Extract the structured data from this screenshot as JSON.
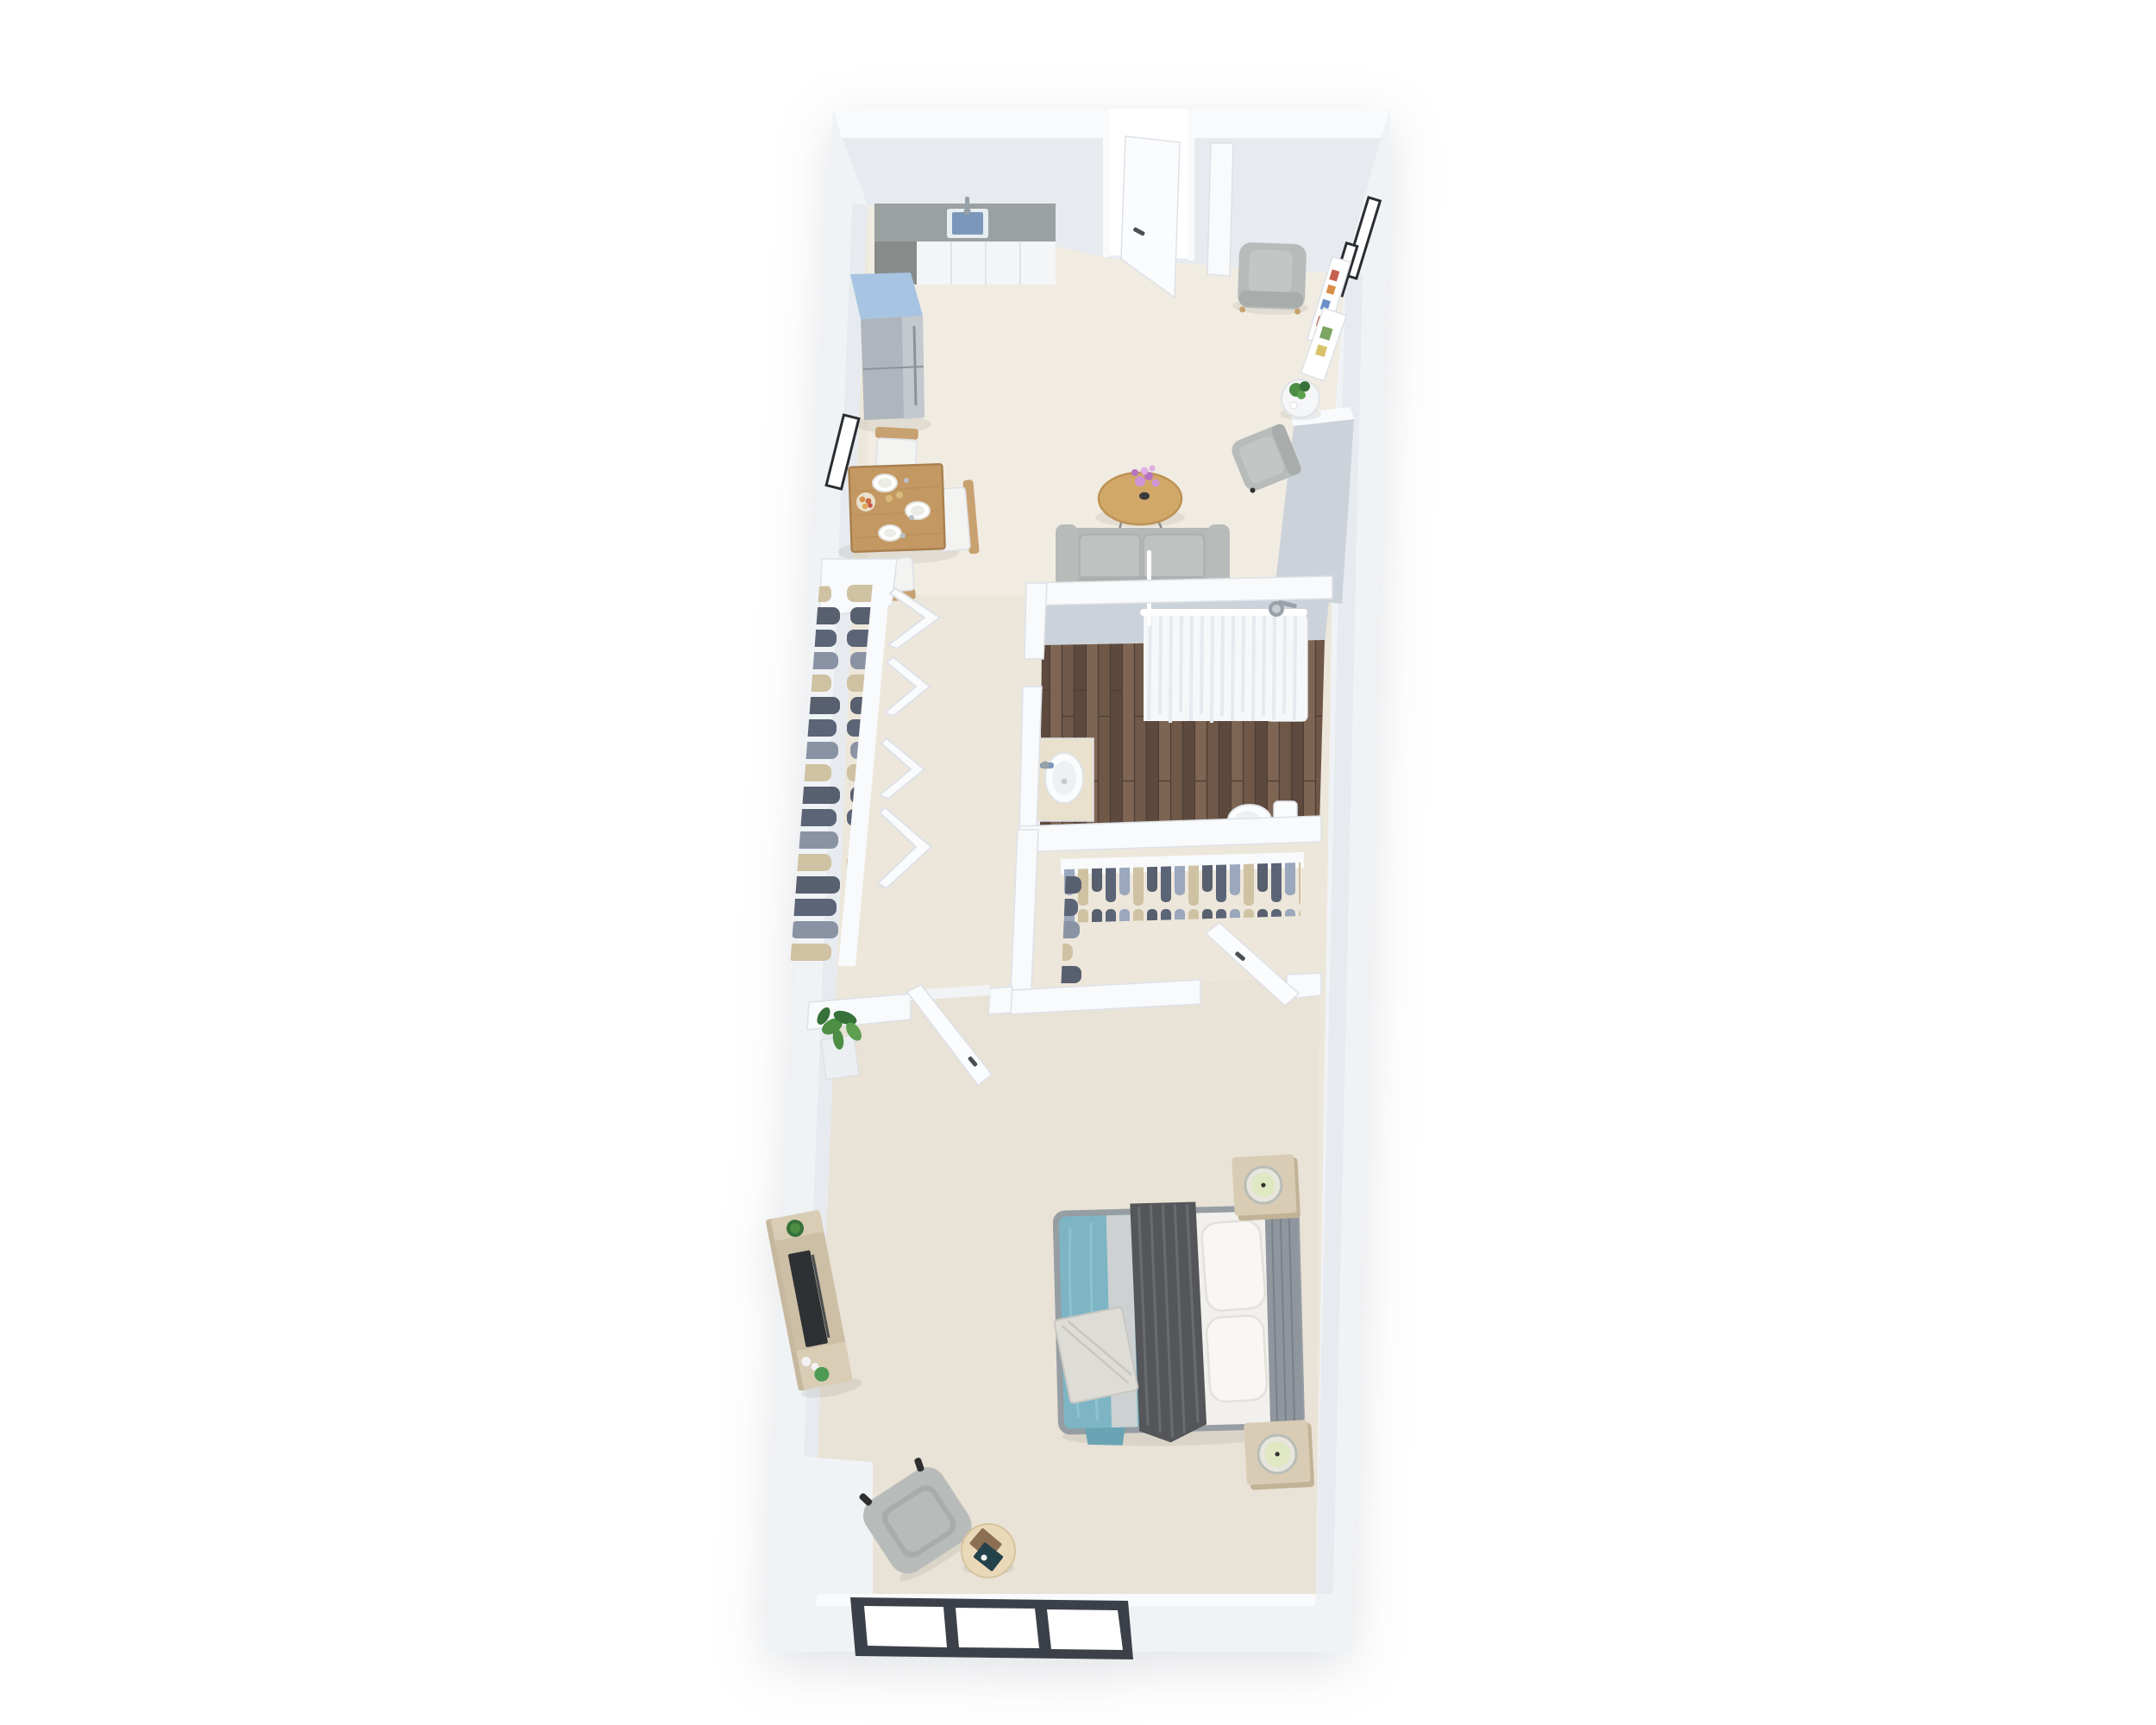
{
  "scene": {
    "type": "3d-floor-plan-render",
    "description": "3D rendered top-down floor plan of a narrow one-bedroom apartment on a white background, wider at the top and tapering toward the bottom",
    "orientation": "vertical, slight perspective lean to the left"
  },
  "rooms": [
    {
      "name": "kitchen-living-dining",
      "position": "top",
      "floor": "cream carpet"
    },
    {
      "name": "hallway-wardrobe",
      "position": "middle-left",
      "floor": "cream carpet"
    },
    {
      "name": "bathroom",
      "position": "middle-right",
      "floor": "dark wood planks"
    },
    {
      "name": "walk-in-closet",
      "position": "middle-right-lower",
      "floor": "cream carpet"
    },
    {
      "name": "bedroom",
      "position": "bottom",
      "floor": "cream carpet"
    }
  ],
  "furniture": {
    "kitchen": [
      "kitchen-counter-with-sink-and-faucet",
      "white-cabinet-fronts",
      "blue-top-refrigerator"
    ],
    "dining": [
      "square-wood-dining-table",
      "three-wood-chairs-with-white-seats",
      "plates",
      "fruit-bowl",
      "candles",
      "black-wall-picture-frame"
    ],
    "living": [
      "gray-sofa",
      "round-wood-coffee-table-with-pink-flowers",
      "gray-armchair-top-right",
      "gray-armchair-right",
      "white-round-side-table-with-plants",
      "gallery-wall-art-frames",
      "open-entry-door"
    ],
    "hallway": [
      "open-wardrobe-with-hanging-clothes",
      "white-folding-closet-panels",
      "potted-plant",
      "open-bedroom-door"
    ],
    "bathroom": [
      "shower-with-white-curtain-and-shower-head",
      "white-tub-base",
      "vanity-counter-with-round-basin-and-faucet",
      "toilet"
    ],
    "walk_in_closet": [
      "hanging-clothes-rail-north",
      "hanging-clothes-rail-west",
      "open-closet-door"
    ],
    "bedroom": [
      "double-bed-teal-duvet-dark-throw-white-pillows",
      "gray-headboard",
      "folded-blanket",
      "two-tan-nightstands-with-candles",
      "wood-media-console-with-tv-succulent-decor",
      "gray-armchair",
      "round-blond-side-table-with-books",
      "three-pane-window-dark-frame",
      "corner-plant"
    ]
  },
  "colors": {
    "background": "#ffffff",
    "wall": "#f0f3f6",
    "wall_bright": "#f8fafc",
    "wall_face": "#e7ebf0",
    "wall_face_dark": "#ccd2d9",
    "wall_edge": "#dde1e7",
    "floor_living": "#f1ece2",
    "floor_bedroom": "#e9e2d6",
    "floor_base": "#ede7db",
    "wood_floor": "#6f5848",
    "wood_floor_light": "#7e6553",
    "wood_floor_dark": "#5d493d",
    "counter_top": "#9ba1a0",
    "counter_side": "#878c8a",
    "cabinet": "#f4f5f6",
    "sink_rim": "#e8edf1",
    "sink_basin": "#7b98ba",
    "faucet": "#98a0a8",
    "fridge_top": "#a7c4e2",
    "fridge_body": "#aeb5bc",
    "fridge_light": "#c3c9cf",
    "wood_table": "#c49862",
    "wood_table_edge": "#a98050",
    "wood_chair": "#c8a171",
    "cushion": "#f3f3f1",
    "coffee_table": "#d2a868",
    "coffee_table_edge": "#bd9255",
    "sofa": "#b4b8b7",
    "sofa_cushion": "#bec2c1",
    "sofa_dark": "#a5a9a8",
    "armchair": "#b7bbba",
    "armchair_dark": "#a8acab",
    "side_table": "#f5f6f7",
    "plant_green": "#4c8f44",
    "plant_dark": "#37713a",
    "flower_pink": "#cf93d6",
    "flower_pink_dark": "#b873c0",
    "frame_black": "#2a2d31",
    "frame_white": "#ffffff",
    "curtain": "#f5f7f9",
    "curtain_fold": "#e5eaef",
    "porcelain": "#fbfcfd",
    "pillow_shade": "#e3e1db",
    "counter_marble": "#e9e0cd",
    "door": "#fbfcfd",
    "handle": "#4a4f55",
    "bed_teal": "#7db5c4",
    "bed_teal_dark": "#6aa4b4",
    "bed_throw": "#55565a",
    "bed_throw_light": "#6a6b70",
    "bed_sheet": "#f1f0ed",
    "pillow": "#f8f7f4",
    "headboard": "#8f969d",
    "headboard_dark": "#7a8188",
    "blanket_fold": "#dddcd7",
    "nightstand": "#d9ccb5",
    "nightstand_side": "#c2b296",
    "candle_ring": "#b9bdb8",
    "candle_glow": "#dfe8c2",
    "candle_wick": "#2f2f2f",
    "console": "#d9cdb6",
    "console_side": "#c6b89e",
    "tv": "#2e3134",
    "decor_white": "#f2f2f2",
    "decor_green": "#4f9a52",
    "window_frame": "#3c4149",
    "book_brown": "#8a6f52",
    "book_teal": "#24424a",
    "clothes_navy": "#5c6477",
    "clothes_slate": "#8a93a4",
    "clothes_tan": "#cfc2a2",
    "clothes_charcoal": "#585f6e",
    "clothes_blue": "#9aa7bd",
    "shadow": "rgba(90,85,75,0.10)"
  }
}
